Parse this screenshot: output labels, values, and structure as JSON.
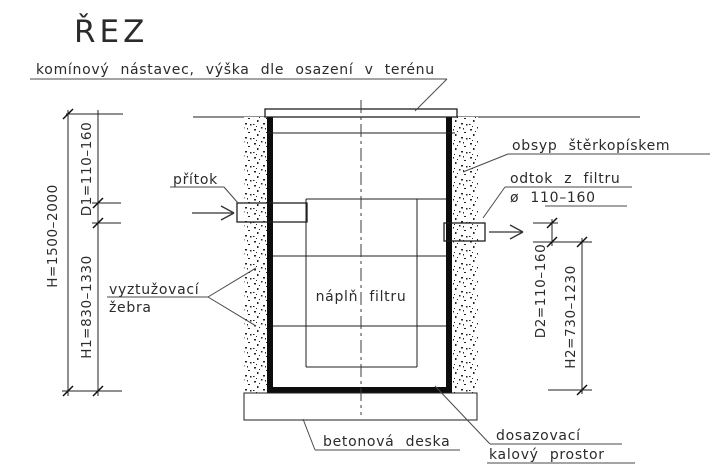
{
  "title": "ŘEZ",
  "callouts": {
    "chimney": "komínový nástavec, výška dle osazení v terénu",
    "backfill": "obsyp štěrkopískem",
    "inlet": "přítok",
    "outlet_line1": "odtok z filtru",
    "outlet_line2": "ø 110–160",
    "filter_fill": "náplň filtru",
    "ribs_line1": "vyztužovací",
    "ribs_line2": "žebra",
    "slab": "betonová deska",
    "sludge_line1": "dosazovací",
    "sludge_line2": "kalový prostor"
  },
  "dimensions": {
    "overall_height": "H=1500–2000",
    "inlet_diameter": "D1=110–160",
    "inlet_height": "H1=830–1330",
    "outlet_diameter": "D2=110–160",
    "outlet_height": "H2=730–1230"
  },
  "colors": {
    "drawing_line": "#1f1f1f",
    "thick_wall": "#0d0d0d",
    "ground_line": "#8f8f8f",
    "leader_line": "#4a4a4a",
    "text": "#2b2b2b",
    "background": "#ffffff"
  }
}
